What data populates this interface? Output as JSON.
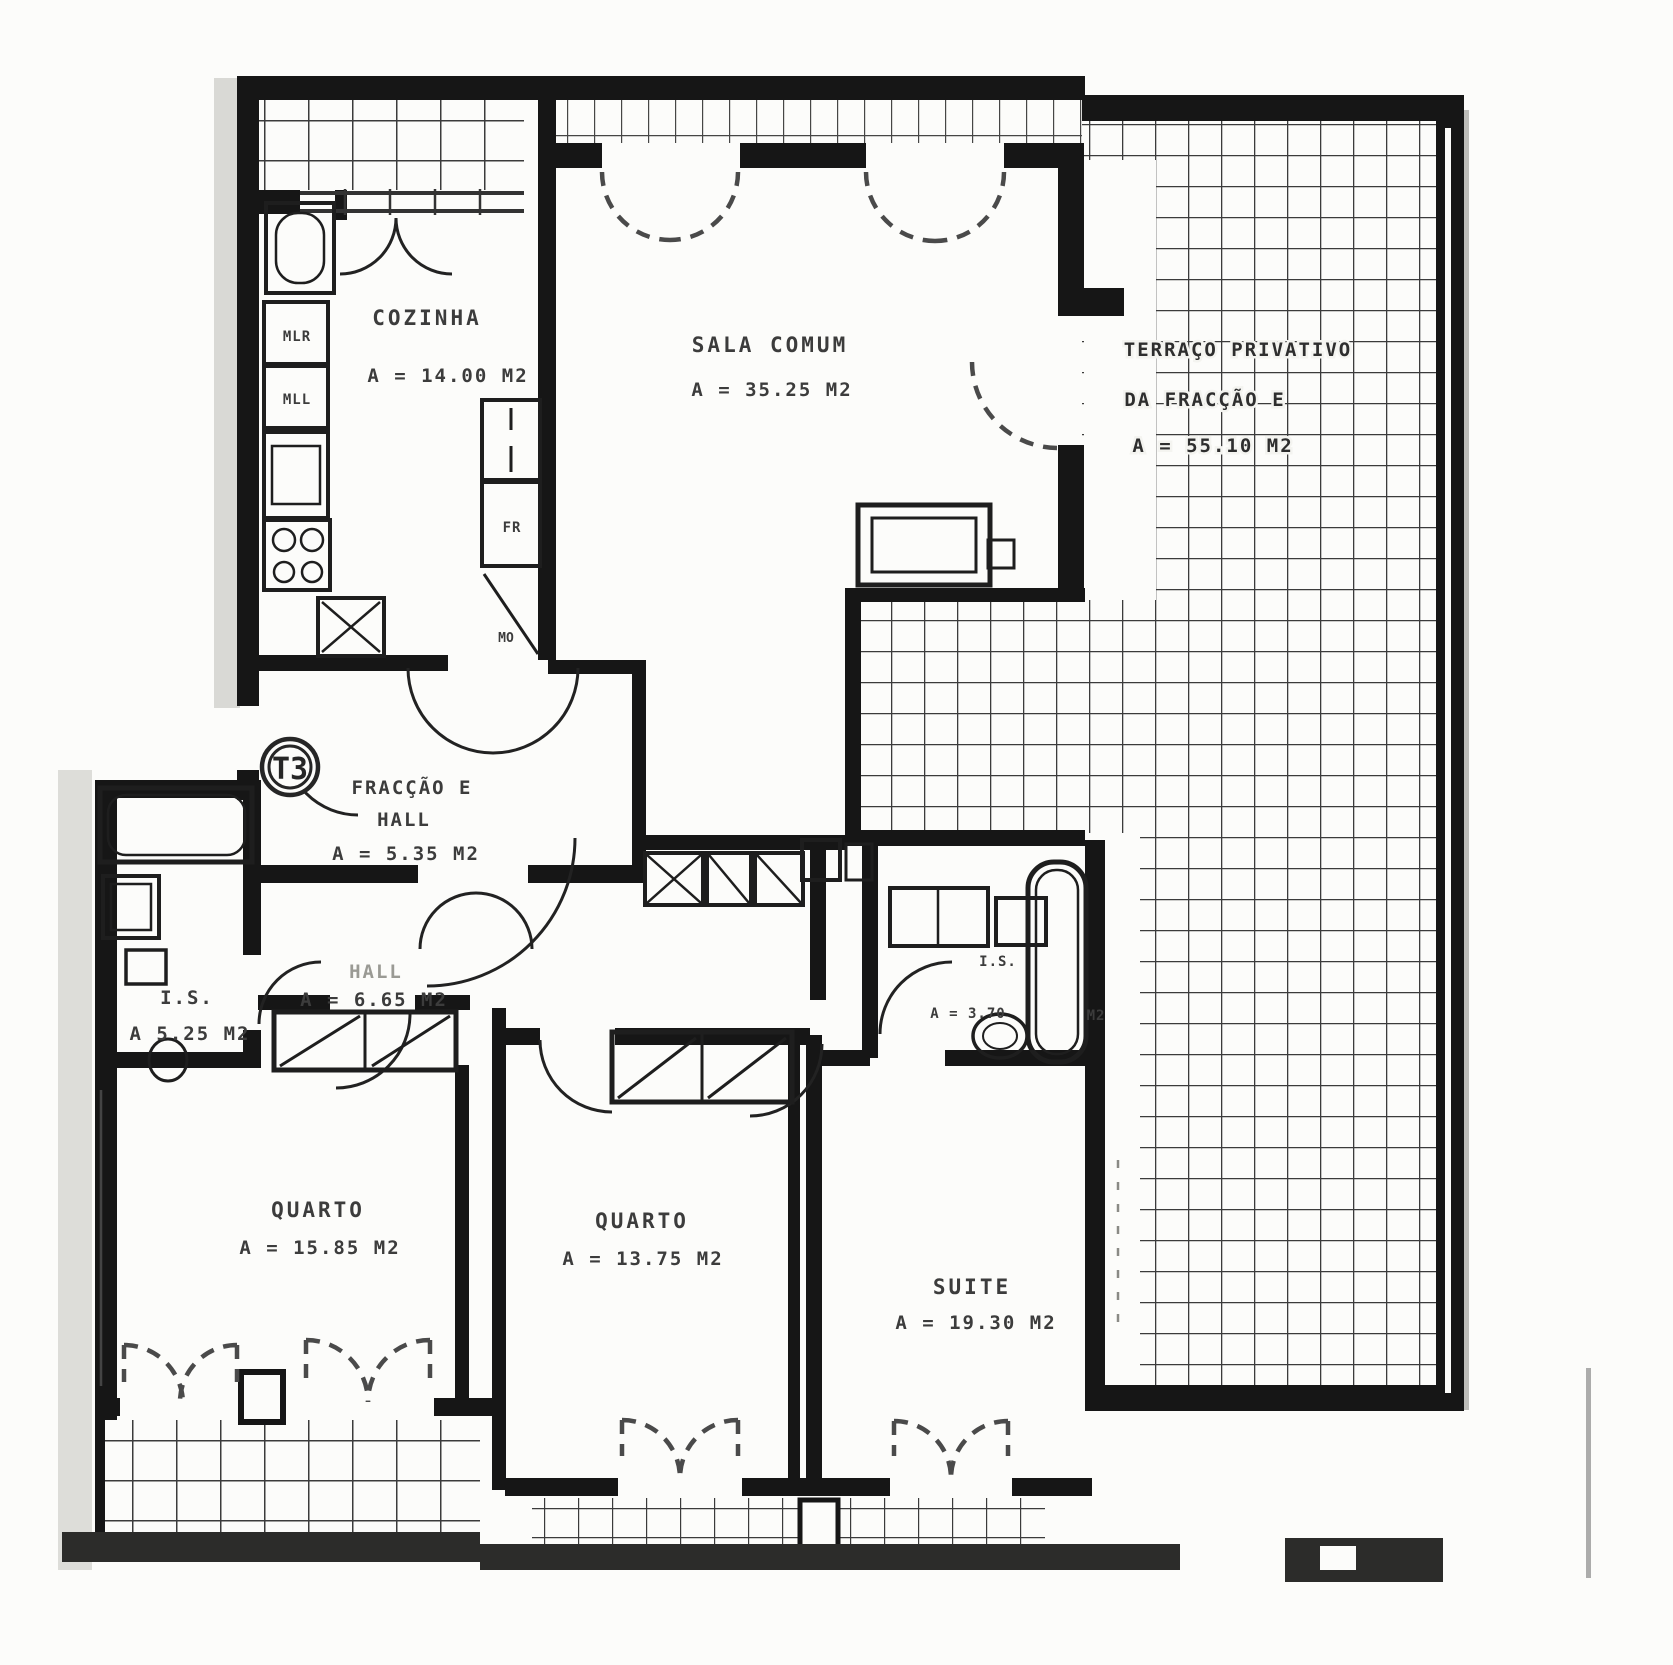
{
  "plan": {
    "unit": {
      "type_label": "T3"
    },
    "rooms": {
      "cozinha": {
        "name": "COZINHA",
        "area": "A  =  14.00 M2"
      },
      "sala_comum": {
        "name": "SALA COMUM",
        "area": "A  =  35.25 M2"
      },
      "terraco": {
        "line1": "TERRAÇO PRIVATIVO",
        "line2": "DA FRACÇÃO E",
        "area": "A  =  55.10 M2"
      },
      "entry_hall": {
        "fraction": "FRACÇÃO E",
        "name": "HALL",
        "area": "A  =  5.35 M2"
      },
      "inner_hall": {
        "name": "HALL",
        "area": "A  =  6.65 M2"
      },
      "is_esquerda": {
        "name": "I.S.",
        "area": "A  5.25 M2"
      },
      "is_suite": {
        "name": "I.S.",
        "area": "A  =  3.70",
        "unit": "M2"
      },
      "quarto_1": {
        "name": "QUARTO",
        "area": "A  =  15.85 M2"
      },
      "quarto_2": {
        "name": "QUARTO",
        "area": "A  =  13.75 M2"
      },
      "suite": {
        "name": "SUITE",
        "area": "A  =  19.30 M2"
      }
    },
    "kitchen_labels": {
      "mlr": "MLR",
      "mll": "MLL",
      "fr": "FR",
      "mo": "MO"
    },
    "colors": {
      "ink": "#1d1d1d",
      "text": "#3c3c3c",
      "paper": "#fcfcfa"
    }
  }
}
